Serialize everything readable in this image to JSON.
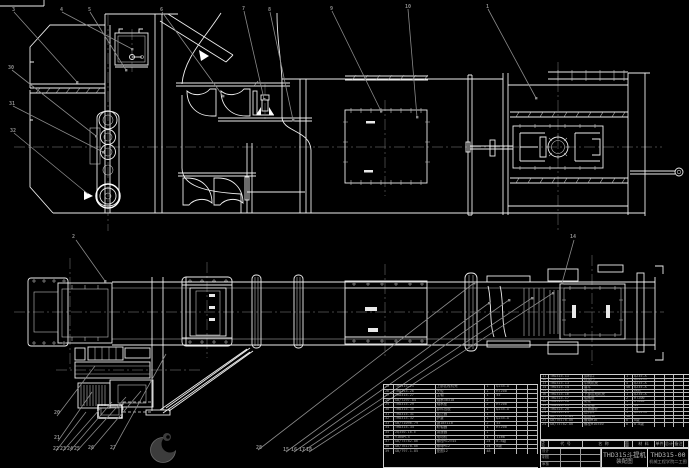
{
  "drawing": {
    "title_block": {
      "product": "THD315斗提机",
      "sheet_name": "装配图",
      "drawing_no": "THD315-00",
      "org": "机械工程学院二工图"
    },
    "bom_header_labels": [
      "序号",
      "代  号",
      "名  称",
      "数量",
      "材 料",
      "单件",
      "总计",
      "备注"
    ],
    "signature_labels": [
      [
        "设计",
        "",
        ""
      ],
      [
        "制图",
        "",
        ""
      ],
      [
        "审核",
        "",
        ""
      ]
    ],
    "bom_right": {
      "rows": [
        [
          "11",
          "THD315-11",
          "卸料口",
          "1",
          "Q235-A",
          "",
          "",
          ""
        ],
        [
          "12",
          "THD315-12",
          "检视门",
          "1",
          "Q235-A",
          "",
          "",
          ""
        ],
        [
          "13",
          "THD315-13",
          "中间机壳",
          "4",
          "Q235-A",
          "",
          "",
          ""
        ],
        [
          "14",
          "THD315-14",
          "畚斗",
          "46",
          "Q235-A",
          "",
          "",
          ""
        ],
        [
          "15",
          "THD315-15",
          "畚斗带",
          "1",
          "橡胶",
          "",
          "",
          ""
        ],
        [
          "16",
          "THD315-16",
          "下部区段机壳",
          "1",
          "Q235-A",
          "",
          "",
          ""
        ],
        [
          "17",
          "THD315-17",
          "轴承座",
          "2",
          "HT200",
          "",
          "",
          ""
        ],
        [
          "18",
          "THD315-18",
          "尾轮",
          "1",
          "HT200",
          "",
          "",
          ""
        ],
        [
          "19",
          "THD315-19",
          "尾轮轴",
          "1",
          "45",
          "",
          "",
          ""
        ],
        [
          "20",
          "THD315-20",
          "拉紧螺杆",
          "2",
          "45",
          "",
          "",
          ""
        ],
        [
          "21",
          "THD315-21",
          "进料口",
          "1",
          "Q235-A",
          "",
          "",
          ""
        ],
        [
          "22",
          "GB/T97.1-85",
          "垫圈16",
          "16",
          "",
          "",
          "",
          ""
        ],
        [
          "23",
          "GB/T6170-86",
          "螺母M16",
          "8",
          "8级",
          "",
          "",
          ""
        ],
        [
          "24",
          "GB/T5782-86",
          "螺栓M16×50",
          "8",
          "8.8级",
          "",
          "",
          ""
        ]
      ]
    },
    "bom_left": {
      "rows": [
        [
          "25",
          "THD315-25",
          "上部区段机壳",
          "1",
          "Q235-A",
          "",
          ""
        ],
        [
          "26",
          "THD315-26",
          "头轮",
          "1",
          "HT200",
          "",
          ""
        ],
        [
          "27",
          "THD315-27",
          "主轴",
          "1",
          "45",
          "",
          ""
        ],
        [
          "28",
          "GB/T297-84",
          "轴承30310",
          "2",
          "",
          "",
          ""
        ],
        [
          "29",
          "THD315-29",
          "轴承座",
          "2",
          "HT200",
          "",
          ""
        ],
        [
          "30",
          "THD315-30",
          "卸料挡板",
          "1",
          "Q235-A",
          "",
          ""
        ],
        [
          "31",
          "THD315-31",
          "逆止器",
          "1",
          "",
          "",
          ""
        ],
        [
          "32",
          "THD315-32",
          "护罩",
          "1",
          "Q235-A",
          "",
          ""
        ],
        [
          "33",
          "GB/T1096-79",
          "键18×110",
          "2",
          "45",
          "",
          ""
        ],
        [
          "34",
          "THD315-34",
          "联轴器",
          "1",
          "HT200",
          "",
          ""
        ],
        [
          "35",
          "ZQ350-16-Ⅱ",
          "减速器",
          "1",
          "",
          "",
          ""
        ],
        [
          "36",
          "Y160M-4",
          "电动机",
          "1",
          "11kW",
          "",
          ""
        ],
        [
          "37",
          "GB/T5782-86",
          "螺栓M12×45",
          "24",
          "8.8级",
          "",
          ""
        ],
        [
          "38",
          "GB/T6170-86",
          "螺母M12",
          "24",
          "8级",
          "",
          ""
        ],
        [
          "39",
          "GB/T97.1-85",
          "垫圈12",
          "48",
          "",
          "",
          ""
        ]
      ]
    },
    "balloons": [
      {
        "n": "3",
        "x": 12,
        "y": 8
      },
      {
        "n": "4",
        "x": 60,
        "y": 8
      },
      {
        "n": "5",
        "x": 88,
        "y": 8
      },
      {
        "n": "6",
        "x": 160,
        "y": 8
      },
      {
        "n": "7",
        "x": 242,
        "y": 7
      },
      {
        "n": "8",
        "x": 268,
        "y": 8
      },
      {
        "n": "9",
        "x": 330,
        "y": 7
      },
      {
        "n": "10",
        "x": 405,
        "y": 5
      },
      {
        "n": "1",
        "x": 486,
        "y": 5
      },
      {
        "n": "30",
        "x": 8,
        "y": 66
      },
      {
        "n": "31",
        "x": 9,
        "y": 102
      },
      {
        "n": "32",
        "x": 10,
        "y": 129
      },
      {
        "n": "2",
        "x": 72,
        "y": 235
      },
      {
        "n": "14",
        "x": 570,
        "y": 235
      },
      {
        "n": "20",
        "x": 54,
        "y": 411
      },
      {
        "n": "21",
        "x": 54,
        "y": 436
      },
      {
        "n": "22",
        "x": 53,
        "y": 447
      },
      {
        "n": "23",
        "x": 60,
        "y": 447
      },
      {
        "n": "24",
        "x": 67,
        "y": 447
      },
      {
        "n": "25",
        "x": 74,
        "y": 447
      },
      {
        "n": "26",
        "x": 88,
        "y": 446
      },
      {
        "n": "27",
        "x": 110,
        "y": 446
      },
      {
        "n": "28",
        "x": 256,
        "y": 446
      },
      {
        "n": "15",
        "x": 283,
        "y": 448
      },
      {
        "n": "16",
        "x": 291,
        "y": 448
      },
      {
        "n": "17",
        "x": 299,
        "y": 448
      },
      {
        "n": "18",
        "x": 306,
        "y": 448
      }
    ]
  }
}
